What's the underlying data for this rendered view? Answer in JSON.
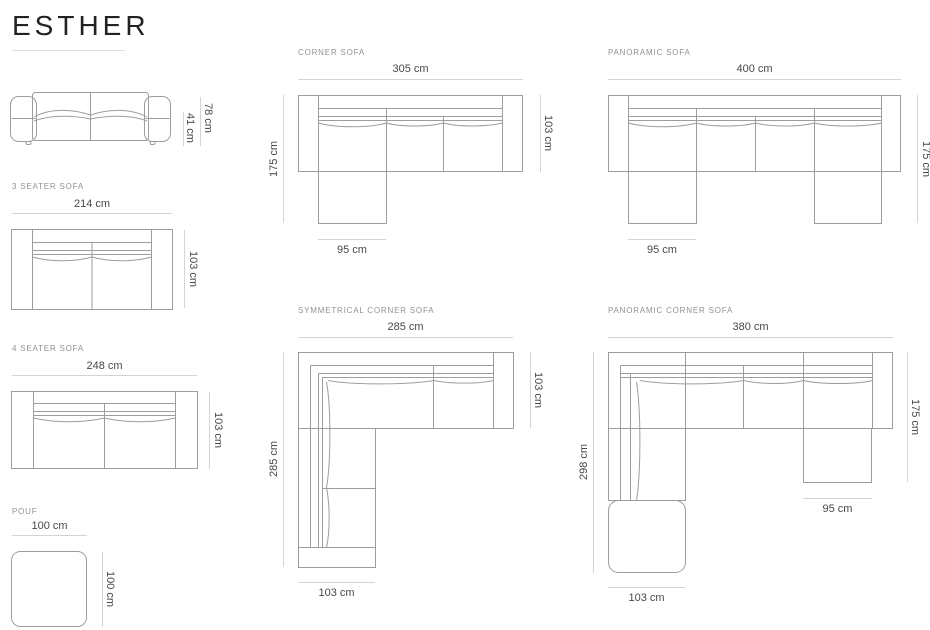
{
  "page": {
    "title": "ESTHER"
  },
  "sections": {
    "front_view": {
      "height_total": "78 cm",
      "seat_height": "41 cm"
    },
    "three_seater": {
      "label": "3 SEATER SOFA",
      "width": "214 cm",
      "depth": "103 cm"
    },
    "four_seater": {
      "label": "4 SEATER SOFA",
      "width": "248 cm",
      "depth": "103 cm"
    },
    "pouf": {
      "label": "POUF",
      "width": "100 cm",
      "depth": "100 cm"
    },
    "corner_sofa": {
      "label": "CORNER SOFA",
      "width": "305 cm",
      "depth": "103 cm",
      "length_left": "175 cm",
      "chaise_width": "95 cm"
    },
    "panoramic_sofa": {
      "label": "PANORAMIC SOFA",
      "width": "400 cm",
      "length_right": "175 cm",
      "chaise_width": "95 cm"
    },
    "symmetrical_corner_sofa": {
      "label": "SYMMETRICAL CORNER SOFA",
      "width": "285 cm",
      "depth": "103 cm",
      "length_left": "285 cm",
      "bottom_width": "103 cm"
    },
    "panoramic_corner_sofa": {
      "label": "PANORAMIC CORNER SOFA",
      "width": "380 cm",
      "length_right": "175 cm",
      "chaise_width": "95 cm",
      "length_left": "298 cm",
      "bottom_width": "103 cm"
    }
  },
  "colors": {
    "drawing_line": "#9b9ea0",
    "dimension_line": "#d4d4d4",
    "dimension_text": "#45494b",
    "section_label_text": "#8f9294",
    "title_text": "#202224"
  }
}
